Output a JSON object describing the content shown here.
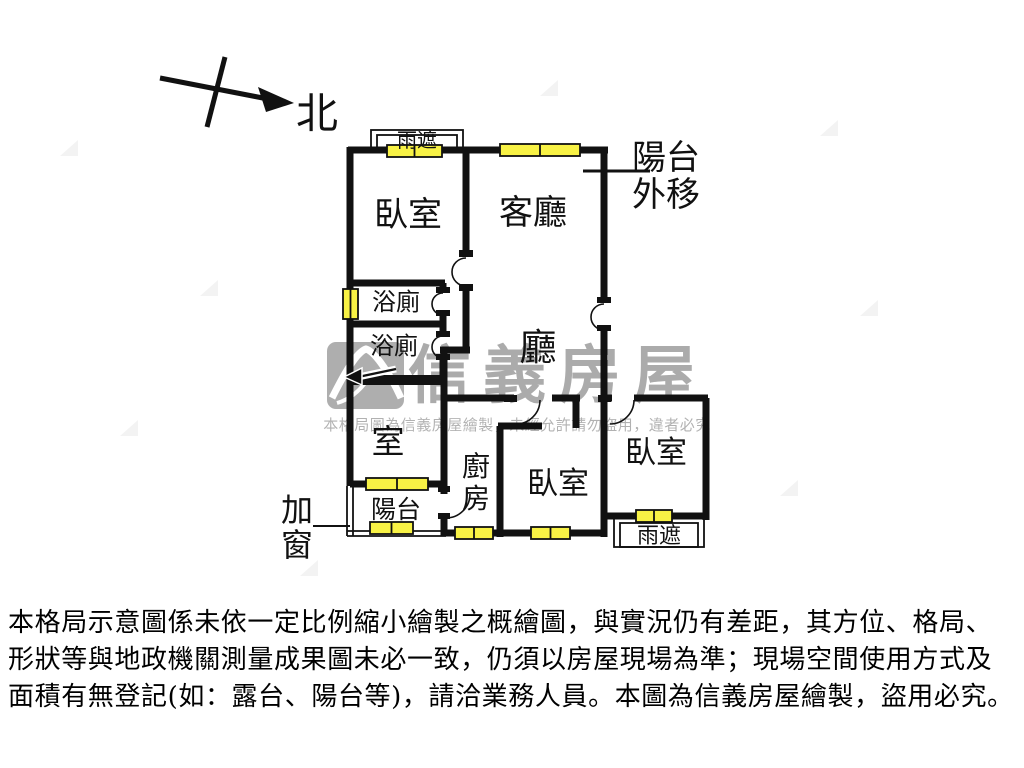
{
  "colors": {
    "wall": "#111111",
    "window_fill": "#f8f245",
    "watermark_gray": "#8a8a8a"
  },
  "compass": {
    "north_label": "北"
  },
  "plan": {
    "rooms": {
      "bedroom_nw": "臥室",
      "living_room": "客廳",
      "bathroom_1": "浴廁",
      "bathroom_2": "浴廁",
      "dining_hall": "廳",
      "room_sw": "室",
      "balcony_sw": "陽台",
      "kitchen_char_1": "廚",
      "kitchen_char_2": "房",
      "bedroom_s": "臥室",
      "bedroom_se": "臥室"
    },
    "annotations": {
      "canopy_top": "雨遮",
      "canopy_bottom": "雨遮",
      "balcony_moved_line_1": "陽台",
      "balcony_moved_line_2": "外移",
      "added_window_line_1": "加",
      "added_window_line_2": "窗"
    }
  },
  "watermark": {
    "brand": "信義房屋",
    "notice": "本格局圖為信義房屋繪製，未經允許請勿盜用，違者必究"
  },
  "disclaimer": {
    "line_1": "本格局示意圖係未依一定比例縮小繪製之概繪圖，與實況仍有差距，其方位、格局、",
    "line_2": "形狀等與地政機關測量成果圖未必一致，仍須以房屋現場為準；現場空間使用方式及",
    "line_3": "面積有無登記(如：露台、陽台等)，請洽業務人員。本圖為信義房屋繪製，盜用必究。"
  }
}
